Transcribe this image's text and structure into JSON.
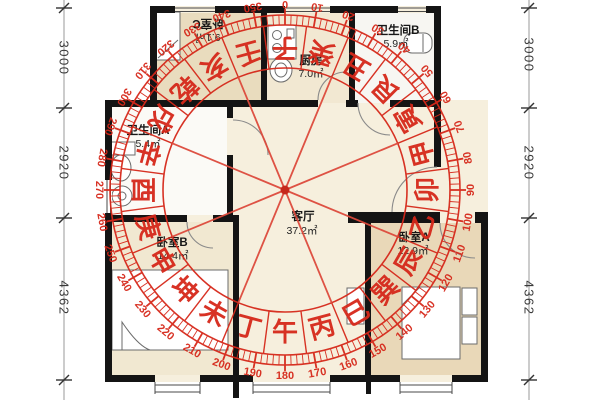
{
  "floor_plan": {
    "rooms": {
      "bedroomC": {
        "name": "卧室C",
        "area": "9.1㎡"
      },
      "kitchen": {
        "name": "厨房",
        "area": "7.0㎡"
      },
      "bathroomB": {
        "name": "卫生间B",
        "area": "5.9㎡"
      },
      "bathroomA": {
        "name": "卫生间A",
        "area": "5.4㎡"
      },
      "living": {
        "name": "客厅",
        "area": "37.2㎡"
      },
      "bedroomB": {
        "name": "卧室B",
        "area": "14.4㎡"
      },
      "bedroomA": {
        "name": "卧室A",
        "area": "12.9㎡"
      }
    },
    "dimensions": {
      "left": [
        "3000",
        "2920",
        "4362"
      ],
      "right": [
        "3000",
        "2920",
        "4362"
      ]
    }
  },
  "compass": {
    "color": "#d6281a",
    "spoke_color": "#dd4a3c",
    "degree_step": 10,
    "degree_labels": [
      "0",
      "10",
      "20",
      "30",
      "40",
      "50",
      "60",
      "70",
      "80",
      "90",
      "100",
      "110",
      "120",
      "130",
      "140",
      "150",
      "160",
      "170",
      "180",
      "190",
      "200",
      "210",
      "220",
      "230",
      "240",
      "250",
      "260",
      "270",
      "280",
      "290",
      "300",
      "310",
      "320",
      "330",
      "340",
      "350"
    ],
    "mountains": [
      "子",
      "癸",
      "丑",
      "艮",
      "寅",
      "甲",
      "卯",
      "乙",
      "辰",
      "巽",
      "巳",
      "丙",
      "午",
      "丁",
      "未",
      "坤",
      "申",
      "庚",
      "酉",
      "辛",
      "戌",
      "乾",
      "亥",
      "壬"
    ]
  }
}
